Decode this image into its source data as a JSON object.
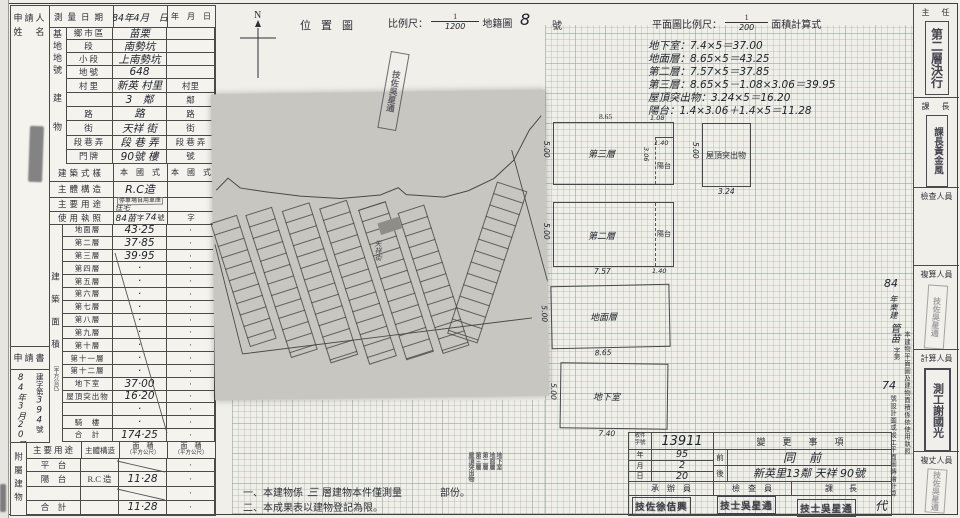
{
  "left_table": {
    "applicant_label_1": "申請人",
    "applicant_label_2": "姓　名",
    "survey": {
      "label": "測量日期",
      "v1": "84年4月　日",
      "v2": "年　月　日"
    },
    "site_group": "基地地號",
    "site_rows": [
      {
        "label": "鄉市區",
        "v1": "苗栗",
        "v2": ""
      },
      {
        "label": "段",
        "v1": "南勢坑",
        "v2": ""
      },
      {
        "label": "小段",
        "v1": "上南勢坑",
        "v2": ""
      },
      {
        "label": "地號",
        "v1": "648",
        "v2": ""
      }
    ],
    "bldg_group": "建物",
    "bldg_rows": [
      {
        "label": "村里",
        "v1": "新英 村里",
        "v2": "村里"
      },
      {
        "label": "",
        "v1": "3　鄰",
        "v2": "鄰"
      },
      {
        "label": "路",
        "v1": "路",
        "v2": "路"
      },
      {
        "label": "街",
        "v1": "天祥 街",
        "v2": "街"
      },
      {
        "label": "段巷弄",
        "v1": "段 巷 弄",
        "v2": "段 巷 弄"
      },
      {
        "label": "門牌",
        "v1": "90號 樓",
        "v2": "號"
      }
    ],
    "style_row": {
      "label": "建築式樣",
      "v1": "本　國　式",
      "v2": "本　國　式"
    },
    "structure_row": {
      "label": "主體構造",
      "v1": "R.C造",
      "v2": ""
    },
    "use_row": {
      "label": "主要用途",
      "stamp": "停車場自用車庫",
      "hand": "住宅",
      "v2": ""
    },
    "license_row": {
      "label": "使用執照",
      "h1": "84苗",
      "p1": "字",
      "h2": "74",
      "p2": "號",
      "v2": "字"
    },
    "area_group": "建築面積",
    "area_unit": "（平方公尺）",
    "floors": [
      {
        "label": "地面層",
        "v1": "43·25",
        "v2": "·"
      },
      {
        "label": "第二層",
        "v1": "37·85",
        "v2": "·"
      },
      {
        "label": "第三層",
        "v1": "39·95",
        "v2": "·"
      },
      {
        "label": "第四層",
        "v1": "·",
        "v2": "·"
      },
      {
        "label": "第五層",
        "v1": "·",
        "v2": "·"
      },
      {
        "label": "第六層",
        "v1": "·",
        "v2": "·"
      },
      {
        "label": "第七層",
        "v1": "·",
        "v2": "·"
      },
      {
        "label": "第八層",
        "v1": "·",
        "v2": "·"
      },
      {
        "label": "第九層",
        "v1": "·",
        "v2": "·"
      },
      {
        "label": "第十層",
        "v1": "·",
        "v2": "·"
      },
      {
        "label": "第十一層",
        "v1": "·",
        "v2": "·"
      },
      {
        "label": "第十二層",
        "v1": "·",
        "v2": "·"
      },
      {
        "label": "地下室",
        "v1": "37·00",
        "v2": "·"
      },
      {
        "label": "屋頂突出物",
        "v1": "16·20",
        "v2": "·"
      },
      {
        "label": "",
        "v1": "·",
        "v2": "·"
      },
      {
        "label": "騎　樓",
        "v1": "·",
        "v2": "·"
      },
      {
        "label": "合　計",
        "v1": "174·25",
        "v2": "·"
      }
    ],
    "application": {
      "label": "申請書",
      "date_chars": "84年3月20日",
      "no_p1": "建字第",
      "no_h": "394",
      "no_p2": "號"
    },
    "annex_group": "附屬建物",
    "annex_headers": {
      "use": "主要用途",
      "structure": "主體構造",
      "area1": "面　積",
      "unit1": "（平方公尺）",
      "area2": "面　積",
      "unit2": "（平方公尺）"
    },
    "annex_rows": [
      {
        "use": "平　台",
        "structure": "",
        "a1": "",
        "a2": "·"
      },
      {
        "use": "陽　台",
        "structure": "R.C 造",
        "a1": "11·28",
        "a2": "·"
      },
      {
        "use": "",
        "structure": "",
        "a1": "",
        "a2": "·"
      },
      {
        "use": "合　計",
        "structure": "",
        "a1": "11·28",
        "a2": "·"
      }
    ]
  },
  "location": {
    "north_label": "N",
    "title": "位置圖",
    "scale_prefix": "比例尺：",
    "scale_num": "1",
    "scale_den": "1200",
    "scale_suffix": "地籍圖",
    "sheet_no": "8",
    "sheet_no_suffix": "號",
    "map_stamp": "技佐吳星通",
    "street_label": "天祥街"
  },
  "plan_header": {
    "prefix": "平面圖比例尺：",
    "num": "1",
    "den": "200",
    "suffix": "面積計算式",
    "calc_lines": [
      {
        "t": "地下室：7.4×5＝37.00"
      },
      {
        "t": "地面層：8.65×5＝43.25"
      },
      {
        "t": "第二層：7.57×5＝37.85"
      },
      {
        "t": "第三層：8.65×5－1.08×3.06＝39.95"
      },
      {
        "t": "屋頂突出物：3.24×5＝16.20"
      },
      {
        "t": "陽台：1.4×3.06＋1.4×5＝11.28"
      }
    ]
  },
  "figures": {
    "f3": {
      "name": "第三層",
      "top": "8.65",
      "left": "5.00",
      "notch_w": "1.08",
      "notch_w2": "1.40",
      "notch_h": "3.06",
      "balcony": "陽台"
    },
    "roof": {
      "name": "屋頂突出物",
      "left": "5.00",
      "bottom": "3.24"
    },
    "f2": {
      "name": "第二層",
      "left": "5.00",
      "bottom": "7.57",
      "balcony": "陽台",
      "balcony_w": "1.40"
    },
    "f1": {
      "name": "地面層",
      "left": "5.00",
      "bottom": "8.65"
    },
    "b1": {
      "name": "地下室",
      "left": "5.00",
      "bottom": "7.40"
    }
  },
  "signoff": [
    {
      "label": "主　任",
      "stamp": "第二層決行"
    },
    {
      "label": "課　長",
      "stamp": "課長黃金風"
    },
    {
      "label": "檢查人員",
      "stamp": ""
    },
    {
      "label": "複算人員",
      "stamp": "技佐吳星通"
    },
    {
      "label": "計算人員",
      "stamp": "測工謝國光"
    },
    {
      "label": "複丈人員",
      "stamp": "技佐吳星通"
    }
  ],
  "license_note": {
    "h_year": "84",
    "h_mid": "年栗建",
    "h_word": "管苗",
    "h_prefix": "字第",
    "h_no": "74",
    "printed_right": "本建物平面圖及建物面積係依使用執照",
    "printed_left": "號設計圖或竣工平面圖轉繪計算"
  },
  "notes": {
    "n1_pre": "一、本建物係",
    "n1_hand": "三",
    "n1_mid": "層建物本件僅測量",
    "n1_stamp": [
      {
        "t": "地下室"
      },
      {
        "t": "地面層"
      },
      {
        "t": "第二層"
      },
      {
        "t": "第三層"
      },
      {
        "t": "屋頂突出物"
      }
    ],
    "n1_post": "部份。",
    "n2": "二、本成果表以建物登記為限。"
  },
  "change": {
    "recv_label_1": "收件",
    "recv_label_2": "字號",
    "recv_no": "13911",
    "date_rows": [
      {
        "label": "年",
        "v": "95"
      },
      {
        "label": "月",
        "v": "2"
      },
      {
        "label": "日",
        "v": "20"
      }
    ],
    "header": "變　更　事　項",
    "before_label": "前",
    "before_value": "同前",
    "after_label": "後",
    "after_value": "新英里13鄰 天祥 90號",
    "staff": [
      {
        "label": "承　辦　員",
        "stamp": "技佐徐佶興",
        "extra": ""
      },
      {
        "label": "檢　查　員",
        "stamp": "技士吳星通",
        "extra": ""
      },
      {
        "label": "課　　長",
        "stamp": "技士吳星通",
        "extra": "代"
      }
    ]
  }
}
